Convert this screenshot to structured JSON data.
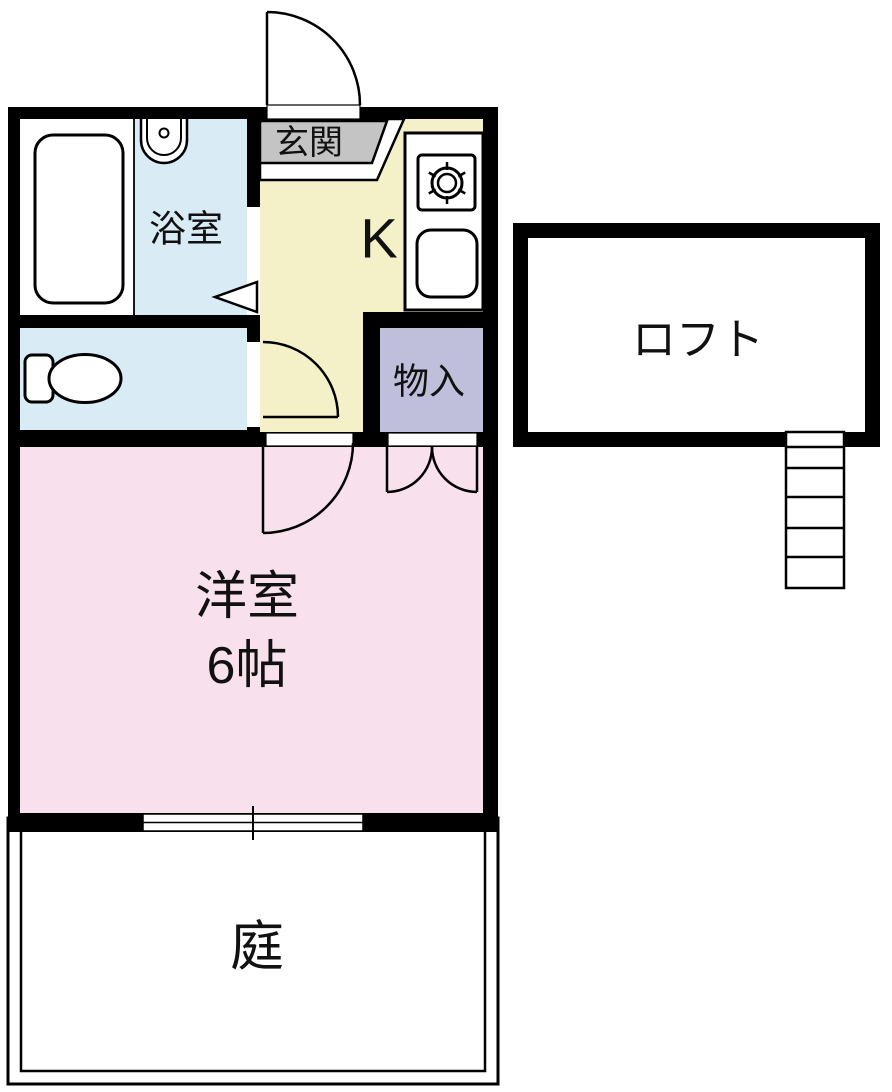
{
  "floorplan": {
    "rooms": {
      "genkan": {
        "label": "玄関"
      },
      "bathroom": {
        "label": "浴室"
      },
      "kitchen": {
        "label": "K"
      },
      "storage": {
        "label": "物入"
      },
      "loft": {
        "label": "ロフト"
      },
      "western_room": {
        "label": "洋室",
        "size_label": "6帖"
      },
      "garden": {
        "label": "庭"
      }
    },
    "colors": {
      "wall": "#000000",
      "bathroom_fill": "#d9ebf5",
      "toilet_fill": "#d9ebf5",
      "kitchen_fill": "#f4f0c8",
      "storage_fill": "#bfbfdb",
      "western_room_fill": "#f8e0ec",
      "genkan_fill": "#c4c4c4",
      "loft_fill": "#ffffff",
      "fixture_fill": "#ffffff",
      "line": "#000000"
    }
  }
}
